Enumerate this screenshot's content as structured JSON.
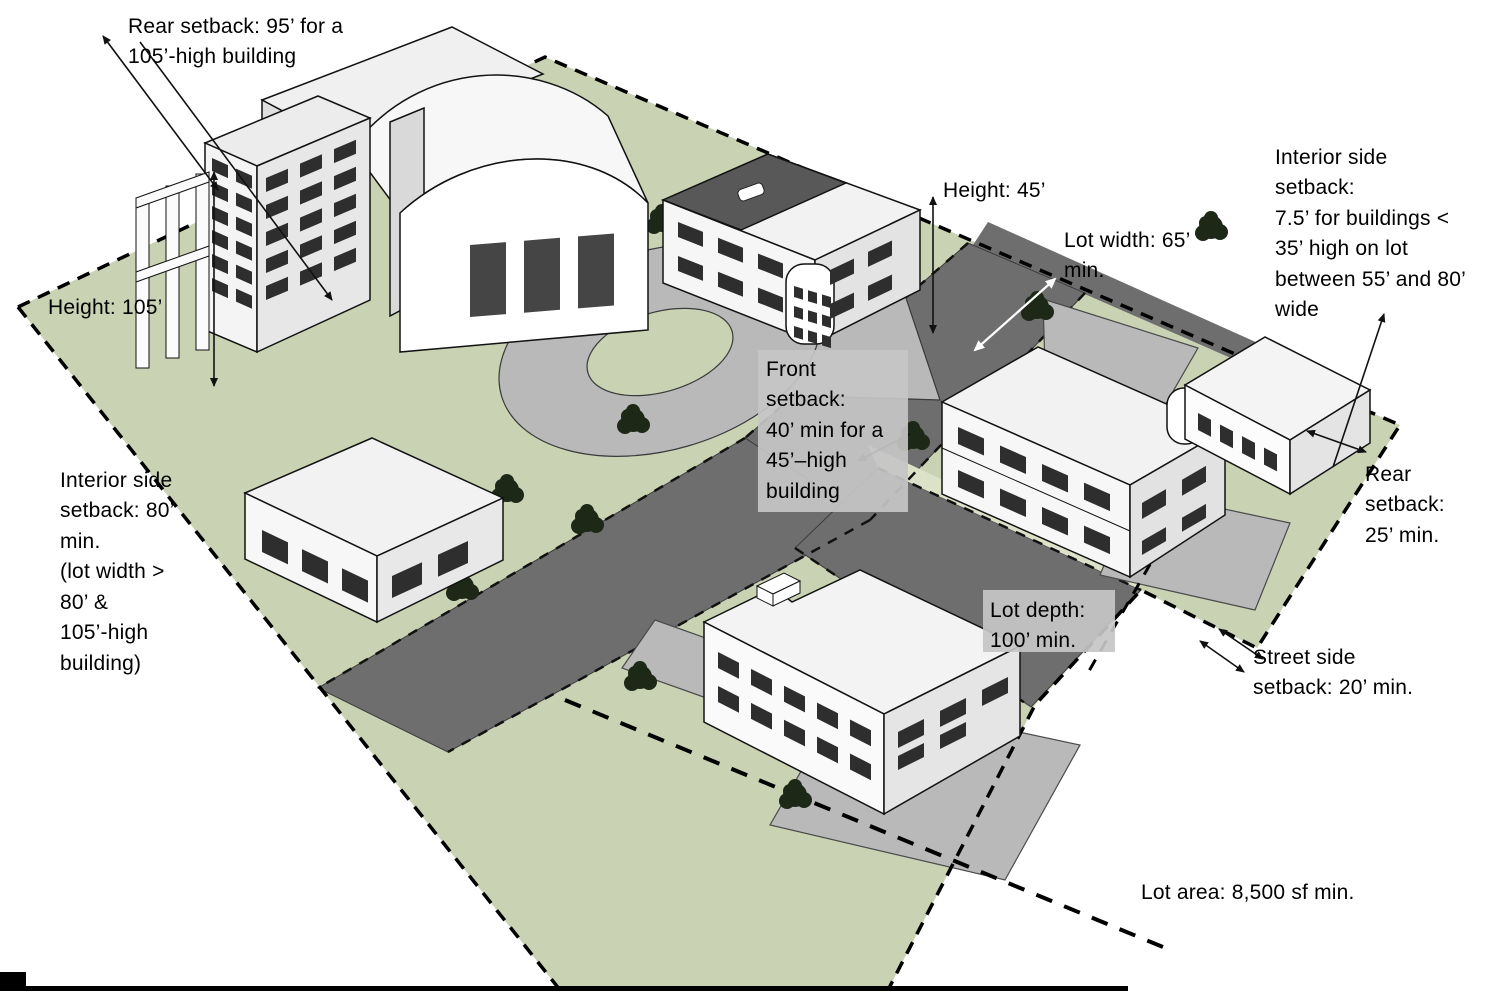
{
  "diagram": {
    "title": "Zoning setback and lot dimension illustration",
    "colors": {
      "lot_green": "#c9d2b3",
      "parkway_green": "#dbe2c8",
      "street_gray": "#6e6e6e",
      "parking_gray": "#b9b9b9",
      "building_white": "#f5f5f5",
      "window_dark": "#2e2e2e",
      "outline_black": "#121212",
      "tree_green": "#1d2817",
      "label_box_gray": "#c5c5c5",
      "text_black": "#000000"
    },
    "labels": {
      "rear_setback_95": "Rear setback: 95’ for a\n105’-high building",
      "height_105": "Height: 105’",
      "height_45": "Height: 45’",
      "lot_width": "Lot width: 65’\nmin.",
      "interior_side_setback_right": "Interior side\nsetback:\n7.5’ for buildings <\n35’ high on lot\nbetween 55’ and 80’\nwide",
      "front_setback": "Front\nsetback:\n40’ min for a\n45’–high\nbuilding",
      "interior_side_setback_left": "Interior side\nsetback: 80’\nmin.\n(lot width >\n80’ &\n105’-high\nbuilding)",
      "rear_setback_25": "Rear\nsetback:\n25’ min.",
      "lot_depth": "Lot depth:\n100’ min.",
      "street_side_setback": "Street side\nsetback: 20’ min.",
      "lot_area": "Lot area: 8,500 sf min."
    }
  }
}
